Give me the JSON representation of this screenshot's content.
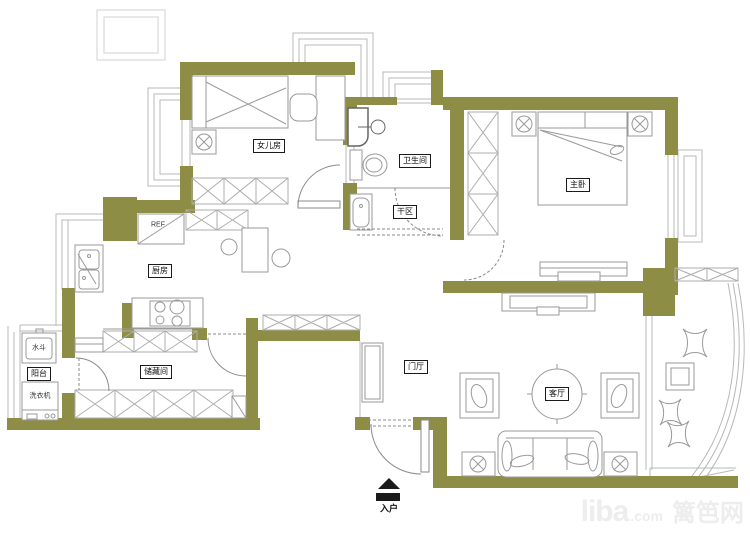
{
  "rooms": {
    "daughter_room": "女儿房",
    "bathroom": "卫生间",
    "dry_area": "干区",
    "master_bedroom": "主卧",
    "kitchen": "厨房",
    "storage": "储藏间",
    "balcony": "阳台",
    "entry_hall": "门厅",
    "living_room": "客厅"
  },
  "fixtures": {
    "refrigerator": "REF",
    "water_basin": "水斗",
    "washing_machine": "洗衣机"
  },
  "entry": {
    "label": "入户"
  },
  "watermark": {
    "brand": "liba",
    "tld": ".com",
    "site": "篱笆网"
  },
  "colors": {
    "wall": "#8d8d45",
    "window_line": "#b8b8b8",
    "furniture_line": "#9a9a9a",
    "hatch_line": "#adadad",
    "door_line": "#8a8a8a",
    "label_text": "#111111",
    "watermark": "#ededed"
  }
}
